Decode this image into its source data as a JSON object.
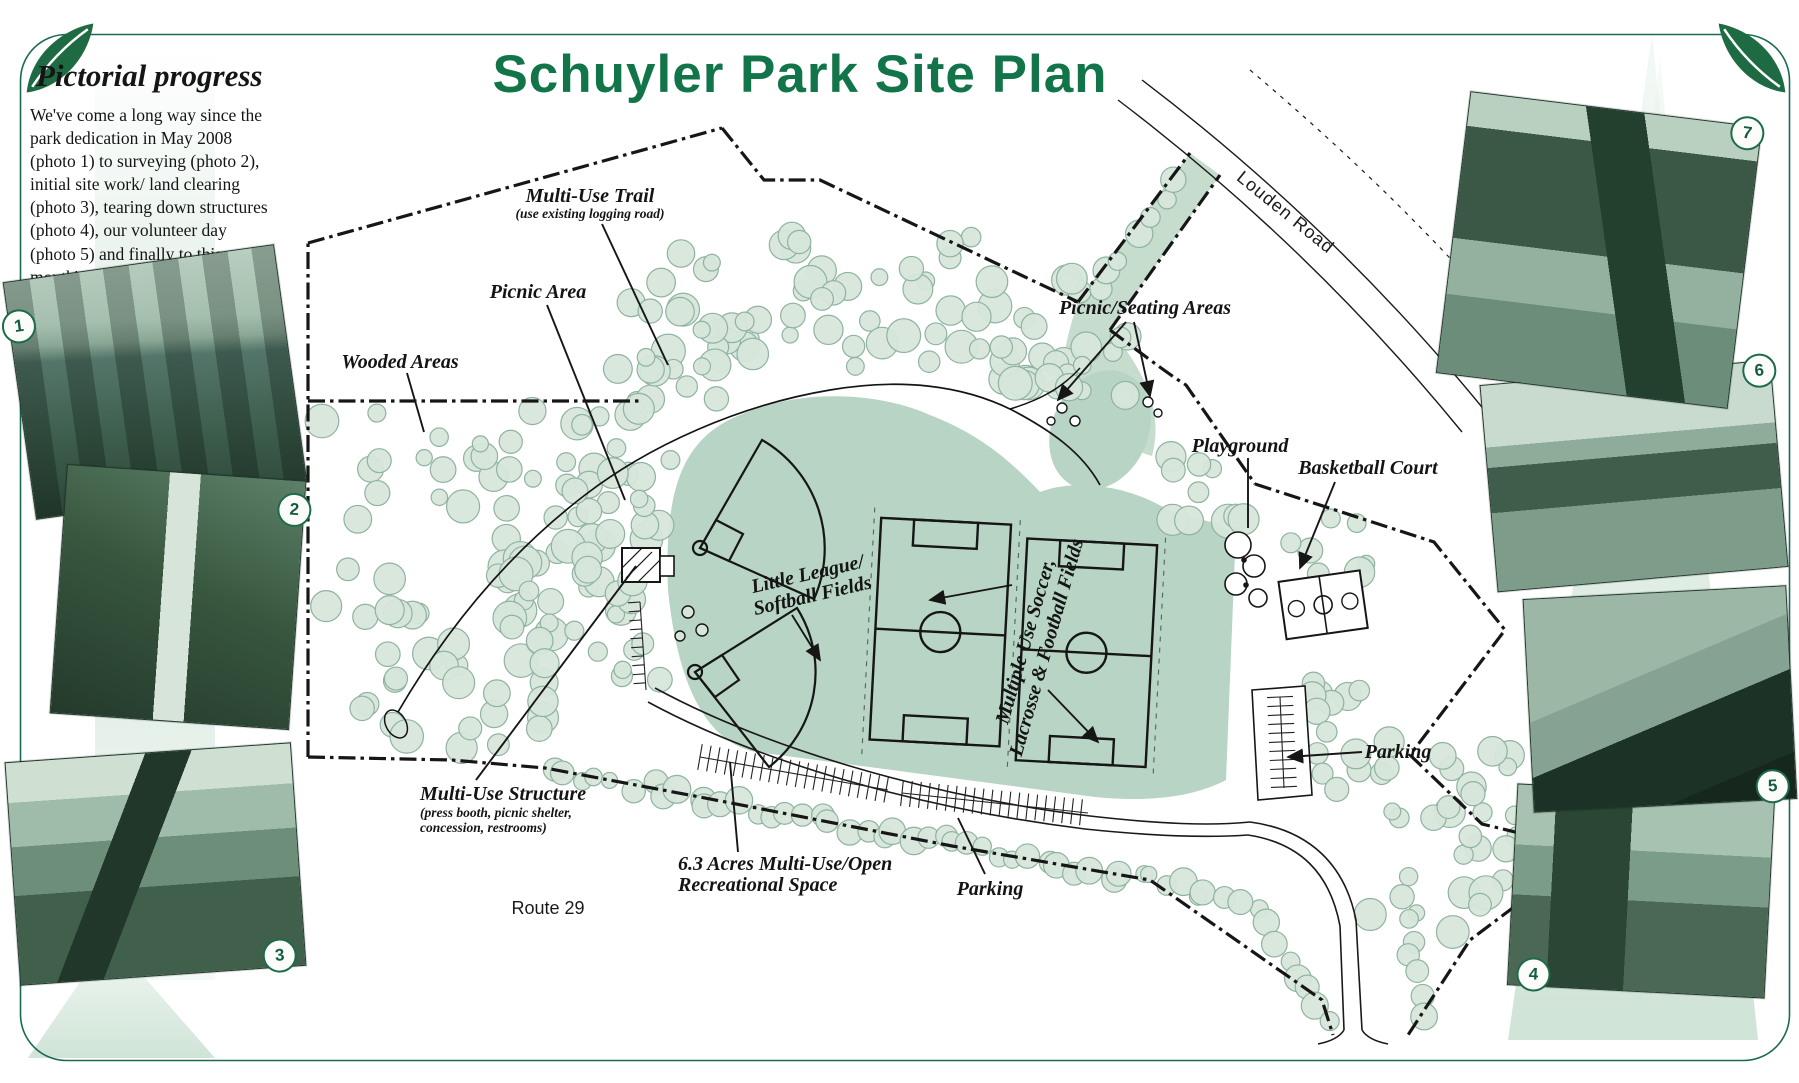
{
  "page": {
    "title": "Schuyler Park Site Plan"
  },
  "sidebar": {
    "heading": "Pictorial progress",
    "body": "We've come a long way since the park dedication in May 2008 (photo 1) to surveying (photo 2), initial site work/ land clearing (photo 3), tearing down structures (photo 4), our volunteer day (photo 5) and finally to this month's site work."
  },
  "map": {
    "labels": {
      "multi_use_trail": "Multi-Use Trail",
      "multi_use_trail_sub": "(use existing logging road)",
      "picnic_area": "Picnic Area",
      "wooded_areas": "Wooded Areas",
      "picnic_seating": "Picnic/Seating Areas",
      "playground": "Playground",
      "basketball": "Basketball Court",
      "little_league_1": "Little League/",
      "little_league_2": "Softball Fields",
      "multiple_use_1": "Multiple Use Soccer,",
      "multiple_use_2": "Lacrosse & Football Fields",
      "structure": "Multi-Use Structure",
      "structure_sub_1": "(press booth, picnic shelter,",
      "structure_sub_2": "concession, restrooms)",
      "open_space_1": "6.3 Acres Multi-Use/Open",
      "open_space_2": "Recreational Space",
      "parking_south": "Parking",
      "parking_east": "Parking",
      "route29": "Route 29",
      "louden_road": "Louden Road"
    }
  },
  "photos": [
    {
      "number": "1",
      "subject": "park dedication ceremony group"
    },
    {
      "number": "2",
      "subject": "volunteers setting survey post"
    },
    {
      "number": "3",
      "subject": "excavator during land clearing"
    },
    {
      "number": "4",
      "subject": "excavator tearing down structures"
    },
    {
      "number": "5",
      "subject": "volunteers carrying tarp"
    },
    {
      "number": "6",
      "subject": "earth-moving machines on site"
    },
    {
      "number": "7",
      "subject": "scraper machine grading soil"
    }
  ],
  "colors": {
    "title_green": "#12754a",
    "border_green": "#1a6b52",
    "field_green": "#b7d4c4",
    "tree_fill": "#d7e6da",
    "tree_stroke": "#8fb3a0",
    "ink": "#161616"
  }
}
